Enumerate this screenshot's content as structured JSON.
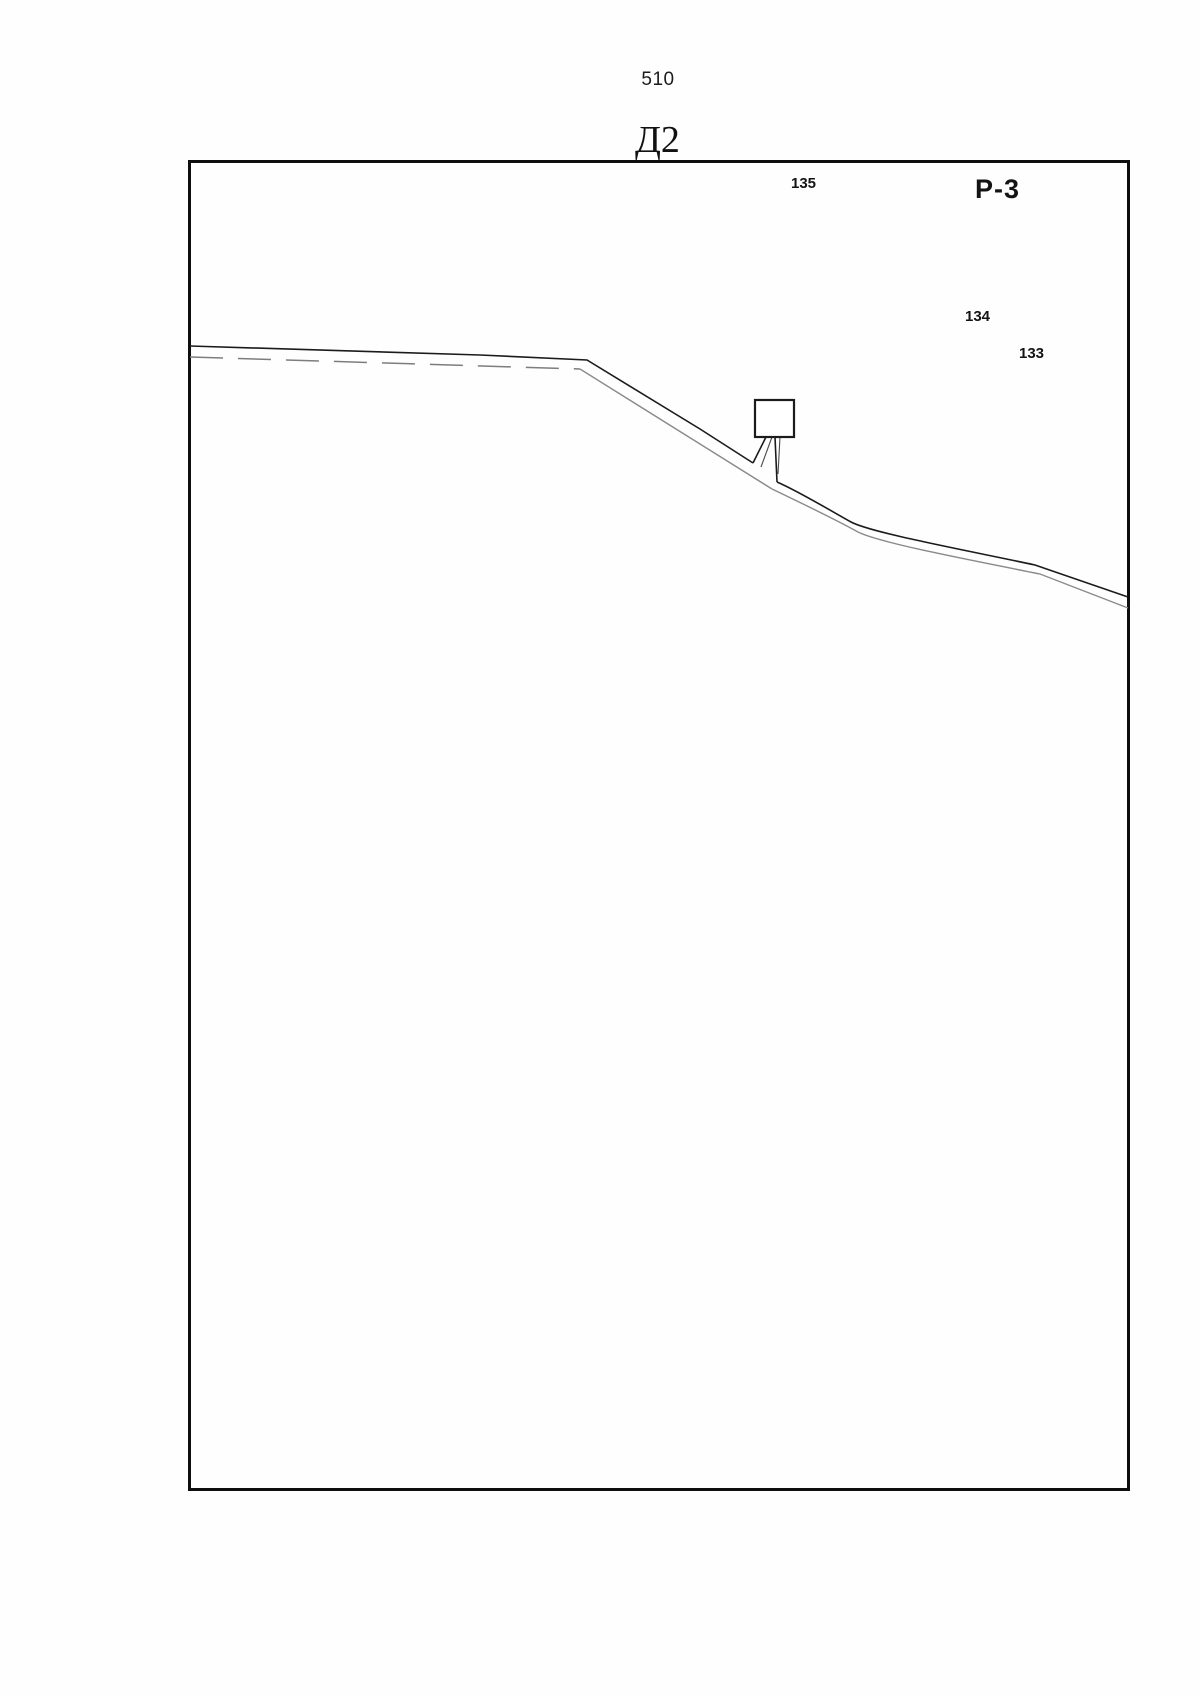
{
  "page": {
    "number": "510",
    "figure_label": "Д2"
  },
  "figure": {
    "region_label": "Р-3",
    "point_labels": {
      "p135": "135",
      "p134": "134",
      "p133": "133"
    }
  },
  "colors": {
    "ink": "#1b1b1b",
    "road_secondary": "#8a8a8a",
    "frame_border": "#0e0e0e",
    "background": "#ffffff"
  }
}
